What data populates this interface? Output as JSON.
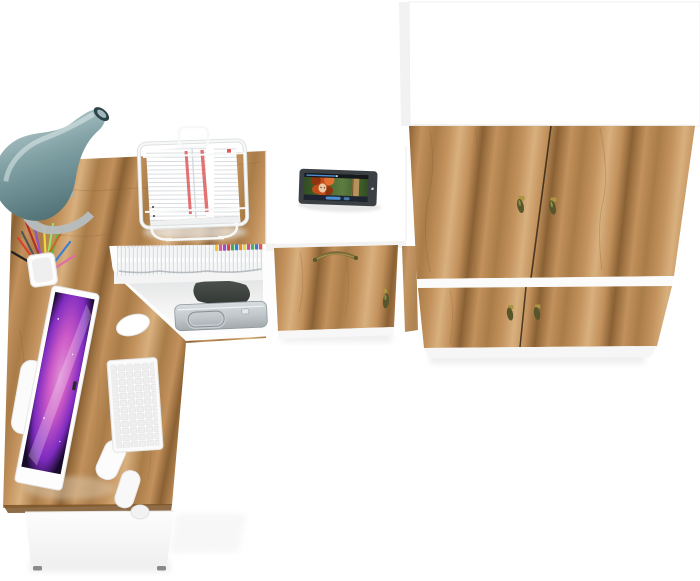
{
  "image": {
    "kind": "furniture-product-render",
    "view": "top-down"
  },
  "items": [
    "wardrobe",
    "corner-desk",
    "desk-hutch-door",
    "under-desk-shelf",
    "desk-lamp",
    "document-stand",
    "pen-cup",
    "imac-monitor",
    "keyboard",
    "mouse",
    "tablet",
    "magazine-row",
    "metal-briefcase"
  ],
  "colors": {
    "background": "#ffffff",
    "wood_light": "#d8b07e",
    "wood_base": "#c2915c",
    "wood_mid": "#a97c48",
    "wood_dark": "#8a6134",
    "wood_edge": "#7a5227",
    "door_divider": "#352818",
    "white_panel": "#ffffff",
    "panel_shade": "#f3f3f3",
    "panel_edge": "#e7e7e7",
    "plinth": "#f6f6f6",
    "floor_shadow": "#ebebeb",
    "foot_grey": "#8a8a8a",
    "lamp_shade_light": "#d2e1e2",
    "lamp_shade_mid": "#82a2a6",
    "lamp_shade_dark": "#47696e",
    "lamp_tip": "#2b4347",
    "lamp_metal": "#b6bec0",
    "handle_gold": "#ad9440",
    "handle_olive": "#56562a",
    "arc_handle": "#7c6a38",
    "tablet_body": "#3b4045",
    "screen_top_bar": "#15181d",
    "player_accent": "#4f8fd0",
    "player_bottom": "#1e2430",
    "movie_green": "#5c7c40",
    "movie_green_dark": "#324e22",
    "movie_pole": "#b5935a",
    "movie_pole_edge": "#6b4f2a",
    "hair_orange": "#c14e1a",
    "hair_dark": "#8e3510",
    "hair_light": "#e2702e",
    "skin": "#ecc9a4",
    "monitor_bezel": "#fdfdfd",
    "nebula_dark": "#170a2a",
    "nebula_purple": "#8a2fd0",
    "nebula_magenta": "#e062d8",
    "nebula_pink": "#f59ae8",
    "key_fill": "#efefef",
    "key_edge": "#dedede",
    "mouse_white": "#ffffff",
    "metal_light": "#d8dde0",
    "metal_dark": "#a2aaae",
    "chrome": "#c6ccd0",
    "dark_object": "#4b504c",
    "dark_object_deep": "#343835",
    "magazine_line": "#c6cbd0",
    "doc_red": "#e05c5c",
    "paper_line": "#c3c8cd",
    "wire_white": "#f7f8f8",
    "wire_shadow": "#dcdfe0"
  },
  "magazine_tabs": {
    "colors": [
      "#e9c930",
      "#e055a0",
      "#8e55c8",
      "#d94343",
      "#3fae58",
      "#3b7fd4",
      "#e88c28",
      "#e1d84a",
      "#d04a9e",
      "#45b556",
      "#4a72d0",
      "#e05555"
    ]
  },
  "pen_colors": [
    "#d8432f",
    "#f09028",
    "#f2d43c",
    "#57b847",
    "#3b7fd4",
    "#222222",
    "#e36aa8",
    "#8e55c8",
    "#9adf66",
    "#555555",
    "#c86a20",
    "#b03030"
  ]
}
